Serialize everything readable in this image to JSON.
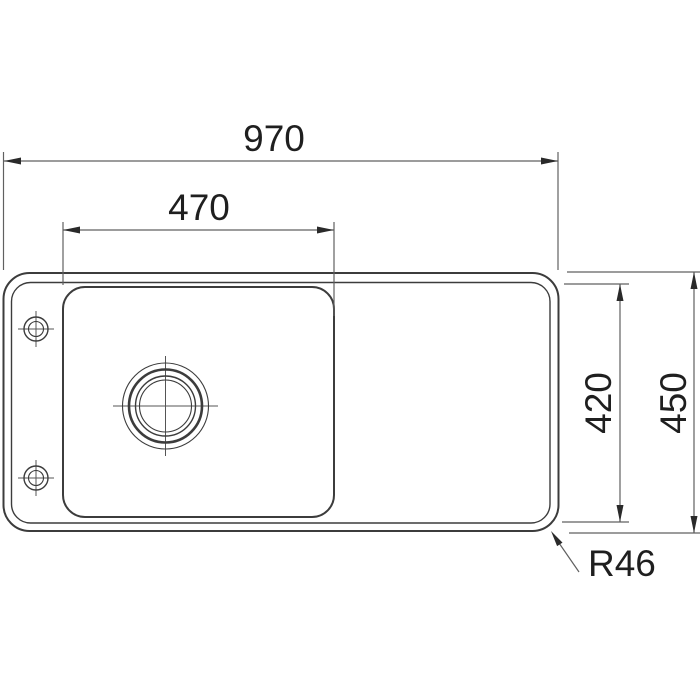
{
  "drawing": {
    "type": "sink-top-view-technical-drawing",
    "dimensions": {
      "overall_width": {
        "label": "970",
        "value": 970,
        "orientation": "horizontal"
      },
      "bowl_width": {
        "label": "470",
        "value": 470,
        "orientation": "horizontal"
      },
      "inner_depth": {
        "label": "420",
        "value": 420,
        "orientation": "vertical"
      },
      "overall_depth": {
        "label": "450",
        "value": 450,
        "orientation": "vertical"
      },
      "corner_radius": {
        "label": "R46",
        "value": 46
      }
    },
    "colors": {
      "background": "#ffffff",
      "outline": "#3c3c3c",
      "centerline": "#555555",
      "dimension_line": "#606060",
      "arrow": "#2a2a2a",
      "text": "#1f1f1f"
    }
  }
}
